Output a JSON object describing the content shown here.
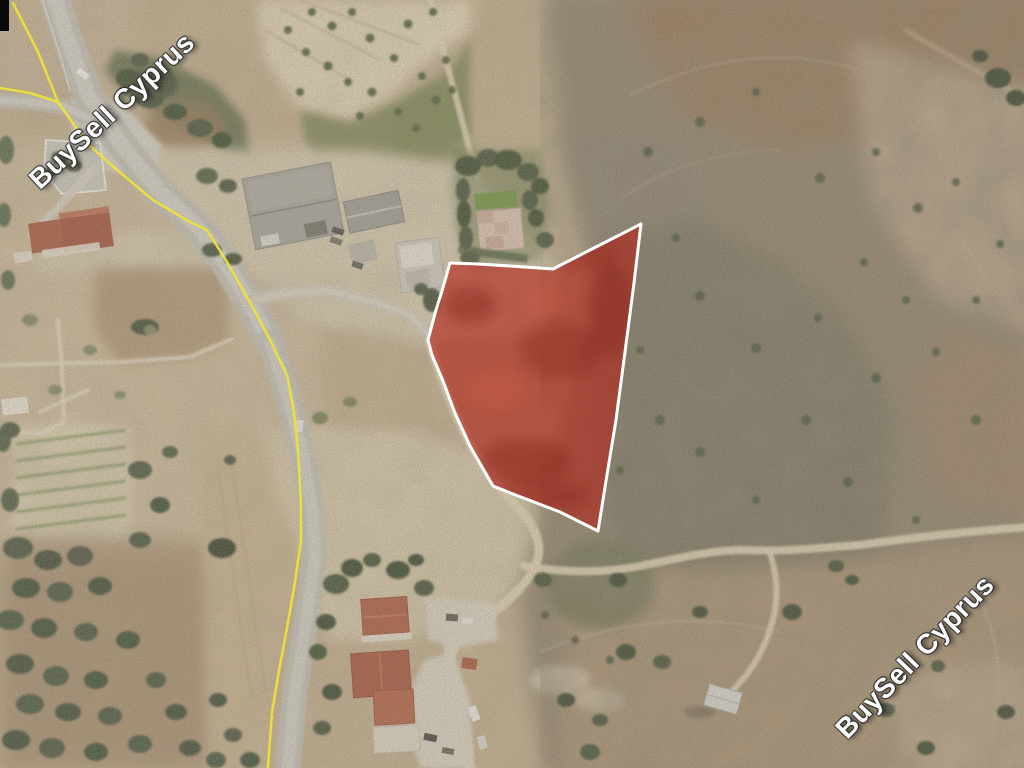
{
  "watermark": {
    "text": "BuySell Cyprus",
    "color": "#ffffff",
    "positions": [
      "top-left",
      "bottom-right"
    ]
  },
  "plot_overlay": {
    "fill_color": "#b22418",
    "fill_opacity": 0.62,
    "border_color": "#ffffff",
    "border_width": 3,
    "points": [
      [
        641,
        224
      ],
      [
        634,
        283
      ],
      [
        625,
        352
      ],
      [
        616,
        420
      ],
      [
        606,
        481
      ],
      [
        598,
        531
      ],
      [
        560,
        512
      ],
      [
        547,
        507
      ],
      [
        513,
        494
      ],
      [
        493,
        486
      ],
      [
        470,
        446
      ],
      [
        455,
        413
      ],
      [
        443,
        381
      ],
      [
        432,
        355
      ],
      [
        428,
        340
      ],
      [
        436,
        310
      ],
      [
        442,
        291
      ],
      [
        450,
        263
      ],
      [
        478,
        264
      ],
      [
        510,
        266
      ],
      [
        553,
        269
      ],
      [
        592,
        249
      ]
    ]
  },
  "boundary_lines": {
    "color": "#ece23a",
    "width": 2.5,
    "main_points": [
      [
        13,
        3
      ],
      [
        38,
        52
      ],
      [
        58,
        102
      ],
      [
        87,
        143
      ],
      [
        117,
        170
      ],
      [
        153,
        200
      ],
      [
        190,
        222
      ],
      [
        207,
        230
      ],
      [
        227,
        262
      ],
      [
        243,
        290
      ],
      [
        257,
        315
      ],
      [
        270,
        340
      ],
      [
        287,
        375
      ],
      [
        294,
        412
      ],
      [
        298,
        450
      ],
      [
        301,
        505
      ],
      [
        301,
        540
      ],
      [
        295,
        582
      ],
      [
        287,
        628
      ],
      [
        280,
        665
      ],
      [
        272,
        712
      ],
      [
        268,
        767
      ]
    ],
    "branch_points": [
      [
        0,
        88
      ],
      [
        30,
        93
      ],
      [
        58,
        102
      ]
    ]
  },
  "corner_marker_color": "#0a0a0a"
}
